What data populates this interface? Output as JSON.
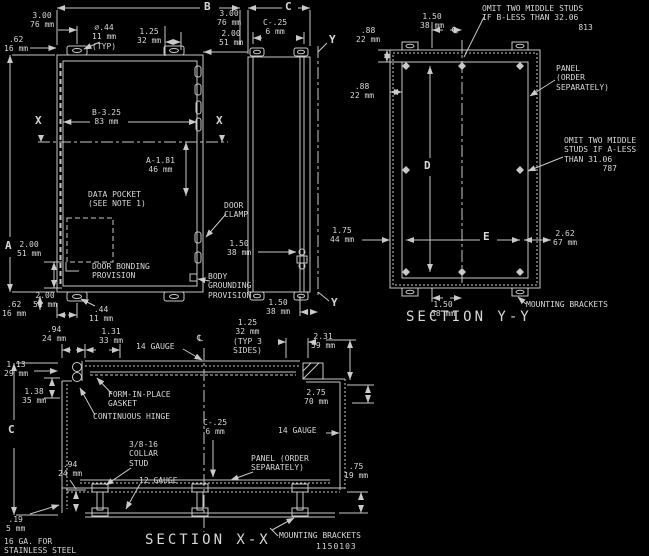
{
  "colors": {
    "background": "#000000",
    "line": "#c9c9c9",
    "text": "#d8d8d8"
  },
  "front_view": {
    "dim_b_label": "B",
    "dim_a_label": "A",
    "top_left_offset": "3.00\n76 mm",
    "top_left_inset": ".62\n16 mm",
    "hole_dia": "⌀.44\n11 mm\n(TYP)",
    "top_center_offset": "1.25\n32 mm",
    "top_right_offset": "3.00\n76 mm",
    "top_right_offset2": "2.00\n51 mm",
    "mid_width": "B-3.25\n83 mm",
    "mid_height": "A-1.81\n46 mm",
    "section_marker_left": "X",
    "section_marker_right": "X",
    "data_pocket_note": "DATA POCKET\n(SEE NOTE 1)",
    "door_bonding_note": "DOOR BONDING\nPROVISION",
    "hinge_offset": "2.00\n51 mm",
    "bottom_offset": "2.00\n51 mm",
    "bottom_inset": ".62\n16 mm",
    "bottom_hole": ".44\n11 mm",
    "bottom_right_offset": "1.50\n38 mm"
  },
  "side_view": {
    "dim_c_label": "C",
    "depth_minus": "C-.25\n6 mm",
    "section_marker_top": "Y",
    "section_marker_bottom": "Y",
    "door_clamp_note": "DOOR\nCLAMP",
    "clamp_spacing": "1.50\n38 mm",
    "body_grounding_note": "BODY\nGROUNDING\nPROVISION"
  },
  "section_yy": {
    "title": "SECTION Y-Y",
    "centerline_symbol": "℄",
    "stud_offset_top": "1.50\n38 mm",
    "flange_return": ".88\n22 mm",
    "flange_return2": ".88\n22 mm",
    "side_offset": "1.75\n44 mm",
    "dim_d_label": "D",
    "dim_e_label": "E",
    "corner_offset": "2.62\n67 mm",
    "bracket_offset": "1.50\n38 mm",
    "mounting_brackets_note": "MOUNTING BRACKETS",
    "note_omit_b": "OMIT TWO MIDDLE STUDS\nIF B-LESS THAN 32.06\n                    813",
    "note_panel": "PANEL\n(ORDER\nSEPARATELY)",
    "note_omit_a": "OMIT TWO MIDDLE\nSTUDS IF A-LESS\nTHAN 31.06\n        787"
  },
  "section_xx": {
    "title": "SECTION X-X",
    "centerline_symbol": "℄",
    "hinge_edge_offset": ".94\n24 mm",
    "door_flange": "1.31\n33 mm",
    "gauge_door": "14 GAUGE",
    "flange_typ": "1.25\n32 mm\n(TYP 3\nSIDES)",
    "door_depth": "2.31\n59 mm",
    "hinge_inset": "1.13\n29 mm",
    "gasket_note": "FORM-IN-PLACE\nGASKET",
    "hinge_clearance": "1.38\n35 mm",
    "hinge_note": "CONTINUOUS HINGE",
    "panel_setback": "2.75\n70 mm",
    "dim_c_label": "C",
    "panel_depth": "C-.25\n6 mm",
    "gauge_body": "14 GAUGE",
    "collar_stud_note": "3/8-16\nCOLLAR\nSTUD",
    "stud_offset": ".94\n24 mm",
    "gauge_bracket": "12 GAUGE",
    "panel_note": "PANEL (ORDER\nSEPARATELY)",
    "bracket_height": ".75\n19 mm",
    "wall_thickness": ".19\n5 mm",
    "stainless_note": "16 GA. FOR\nSTAINLESS STEEL",
    "mounting_brackets_note": "MOUNTING BRACKETS",
    "part_number": "1150103"
  }
}
